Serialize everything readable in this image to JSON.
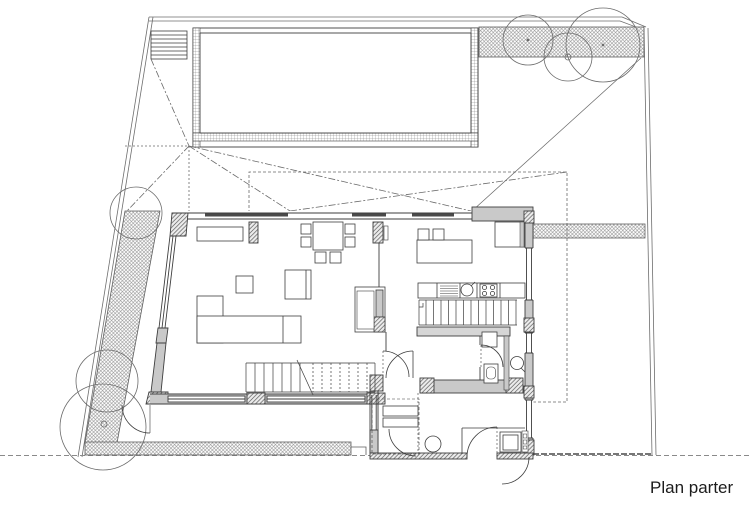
{
  "title": {
    "label": "Plan parter"
  },
  "drawing": {
    "type": "architectural-floor-plan",
    "floor": "ground floor",
    "colors": {
      "background": "#ffffff",
      "building_line": "#3e3e3e",
      "site_line": "#6e6e6e",
      "wall_fill": "#c9c9c9",
      "light_wall_fill": "#d6d6d6",
      "dashed_projection": "#6a6a6a",
      "window_dark_segment": "#4a4a4a"
    },
    "site_features": [
      "property-boundary-top",
      "property-boundary-left",
      "property-boundary-right",
      "street-line-dashed-bottom",
      "hedge-top",
      "hedge-right",
      "hedge-left",
      "hedge-bottom",
      "tree-canopies",
      "swimming-pool",
      "pool-deck-steps",
      "roof-projection-lines",
      "upper-floor-dashed-outline"
    ],
    "rooms": [
      "living-room",
      "dining-area",
      "kitchen",
      "stair-hall",
      "wc",
      "bathroom",
      "entry-vestibule",
      "technical-room"
    ],
    "furniture_fixtures": [
      "l-shaped-sofa",
      "coffee-table",
      "lounge-chair",
      "sideboard",
      "dining-table-with-chairs",
      "fireplace",
      "kitchen-island-with-stools",
      "kitchen-counter",
      "sink",
      "hob",
      "main-staircase",
      "basement-staircase",
      "toilet",
      "washbasin",
      "wardrobe-bench",
      "boiler-unit",
      "door-swings"
    ]
  }
}
